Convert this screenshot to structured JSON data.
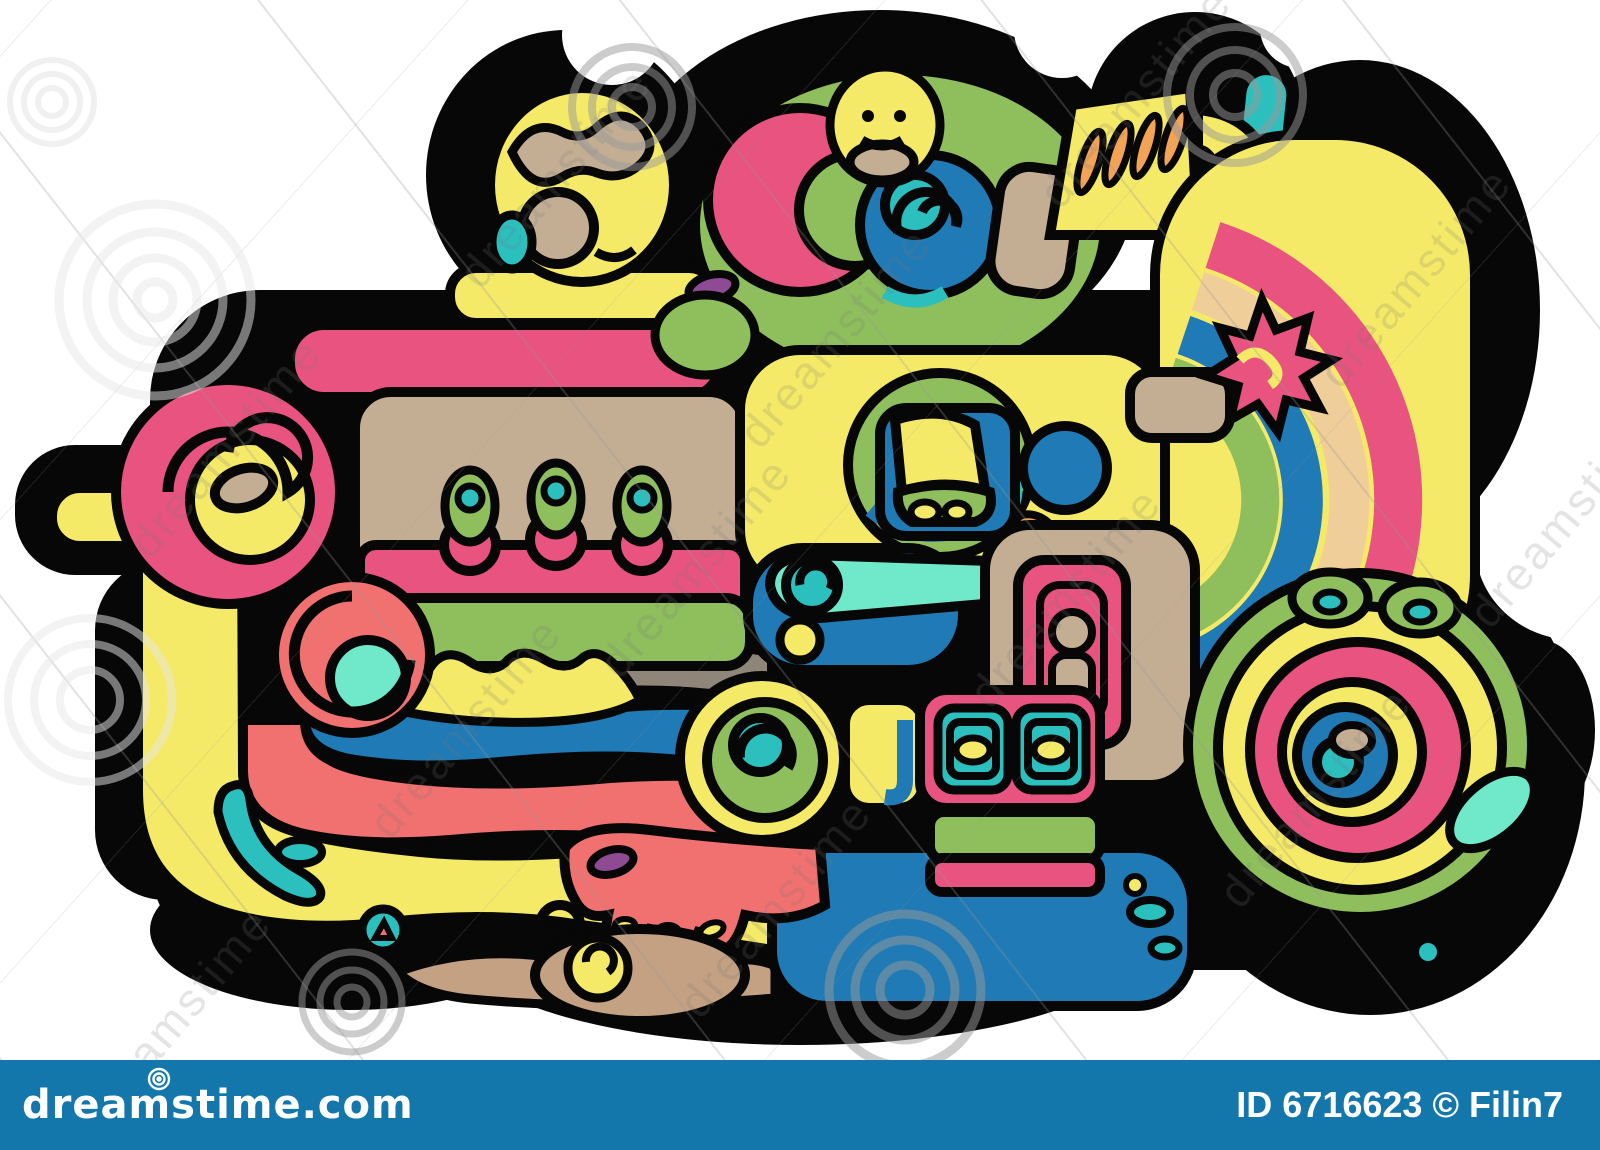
{
  "page": {
    "background": "#ffffff"
  },
  "artwork": {
    "subject": "Colorful Mayan / Aztec style ornament doodle illustration with thick black outlines",
    "outline_color": "#070707",
    "palette": {
      "yellow": "#F5EA67",
      "pink": "#E8537F",
      "salmon": "#F0716F",
      "green": "#8FBE5D",
      "teal": "#2BC0BE",
      "mint": "#6FE9C9",
      "blue": "#1F7AB5",
      "tan": "#C3AE94",
      "dark_tan": "#C4A183",
      "gray": "#8F8578",
      "orange": "#F2A356",
      "purple": "#8E4A93",
      "cream": "#F0CE9A"
    }
  },
  "watermark": {
    "text": "dreamstime",
    "spiral_icon": "spiral-watermark"
  },
  "footer": {
    "brand": "dreamstime.com",
    "credit": "ID 6716623 © Filin7",
    "background": "#1477AC",
    "text_color": "#FFFFFF"
  }
}
